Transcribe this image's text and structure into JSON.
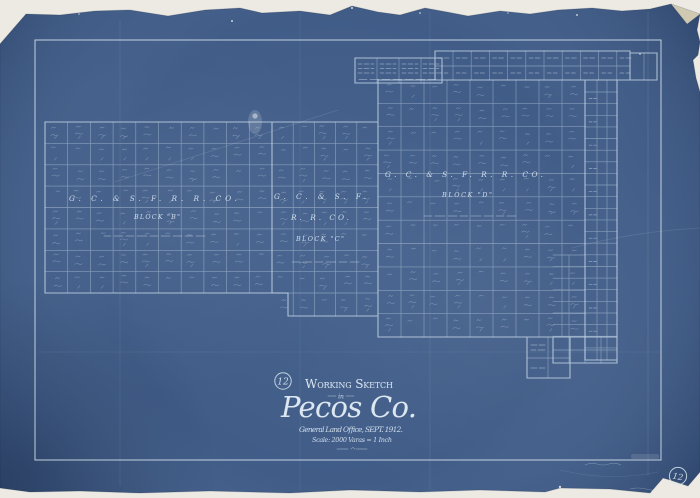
{
  "sheet": {
    "badge_number": "12",
    "corner_number": "12"
  },
  "title_block": {
    "heading": "Working Sketch",
    "connector": "in",
    "county": "Pecos Co.",
    "office_line": "General Land Office, SEPT. 1912.",
    "scale_line": "Scale: 2000 Varas = 1 Inch"
  },
  "blocks": {
    "b": {
      "company": "G. C. & S. F. R. R. CO.",
      "label": "BLOCK \"B\""
    },
    "c": {
      "company_line1": "G. C. & S. F.",
      "company_line2": "R. R. CO.",
      "label": "BLOCK \"C\""
    },
    "d": {
      "company": "G. C. & S. F. R. R. CO.",
      "label": "BLOCK \"D\""
    }
  },
  "colors": {
    "paper": "#ECEAE3",
    "blueprint": "#405C87",
    "line": "#C9DBEA",
    "ink": "#DDE9F4"
  }
}
